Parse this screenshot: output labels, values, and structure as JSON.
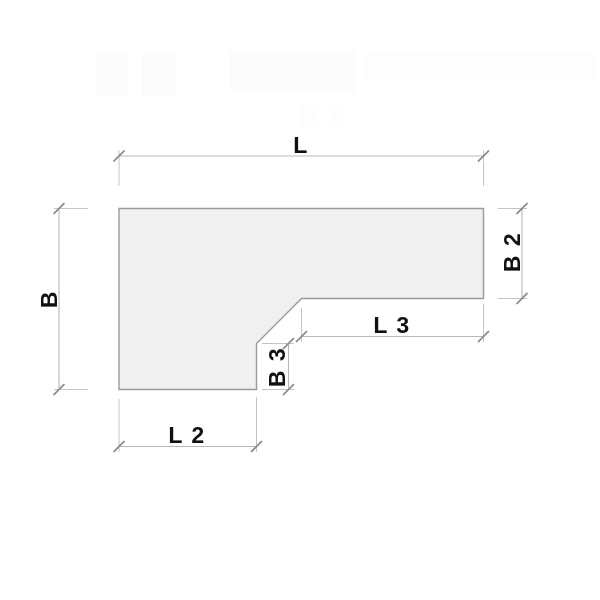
{
  "diagram": {
    "description": "Technical dimension drawing of an L-shaped panel with a 45-degree chamfered inner corner",
    "watermark": "illegible faint logo band at top",
    "labels": {
      "length_total": "L",
      "depth_total": "B",
      "depth_right_arm": "B 2",
      "length_right_underside": "L 3",
      "depth_notch": "B 3",
      "length_bottom_leg": "L 2"
    },
    "colors": {
      "background": "#ffffff",
      "shape_fill": "#f0f0f0",
      "shape_outline": "#9a9a9a",
      "dimension_lines": "#b8b8b8",
      "extension_lines": "#c4c4c4",
      "tick_marks": "#8a8a8a",
      "label_text": "#111111"
    }
  }
}
